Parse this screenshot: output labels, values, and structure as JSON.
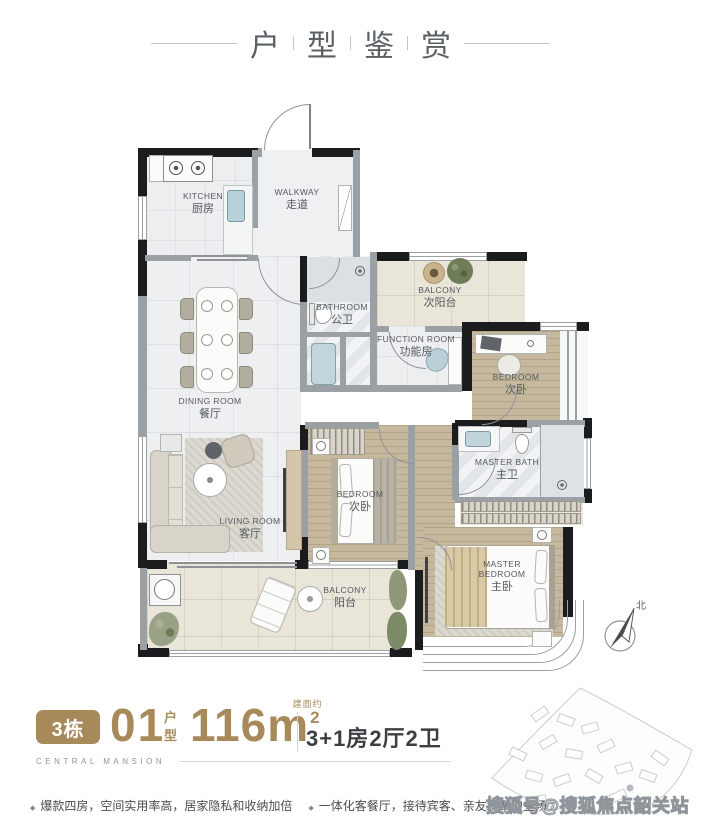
{
  "header": {
    "title_chars": [
      "户",
      "型",
      "鉴",
      "赏"
    ]
  },
  "plan": {
    "rooms": [
      {
        "en": "KITCHEN",
        "cn": "厨房"
      },
      {
        "en": "WALKWAY",
        "cn": "走道"
      },
      {
        "en": "BATHROOM",
        "cn": "公卫"
      },
      {
        "en": "BALCONY",
        "cn": "次阳台"
      },
      {
        "en": "FUNCTION ROOM",
        "cn": "功能房"
      },
      {
        "en": "BEDROOM",
        "cn": "次卧"
      },
      {
        "en": "DINING ROOM",
        "cn": "餐厅"
      },
      {
        "en": "LIVING ROOM",
        "cn": "客厅"
      },
      {
        "en": "BEDROOM",
        "cn": "次卧"
      },
      {
        "en": "MASTER BATH",
        "cn": "主卫"
      },
      {
        "en": "MASTER BEDROOM",
        "cn": "主卧"
      },
      {
        "en": "BALCONY",
        "cn": "阳台"
      }
    ],
    "compass_north": "北"
  },
  "info": {
    "building_badge": "3栋",
    "unit_number": "01",
    "unit_type_label": "户型",
    "area_value": "116m",
    "area_superscript": "2",
    "area_note": "建面约",
    "layout_summary": "3+1房2厅2卫",
    "brand_name": "CENTRAL MANSION"
  },
  "features": [
    {
      "text": "爆款四房，空间实用率高，居家隐私和收纳加倍"
    },
    {
      "text": "一体化客餐厅，接待宾客、亲友欢聚的主场"
    }
  ],
  "watermark": "搜狐号@搜狐焦点韶关站",
  "colors": {
    "accent_gold": "#a8895a",
    "wall_black": "#1b1c1e",
    "wall_gray": "#9aa0a4"
  }
}
